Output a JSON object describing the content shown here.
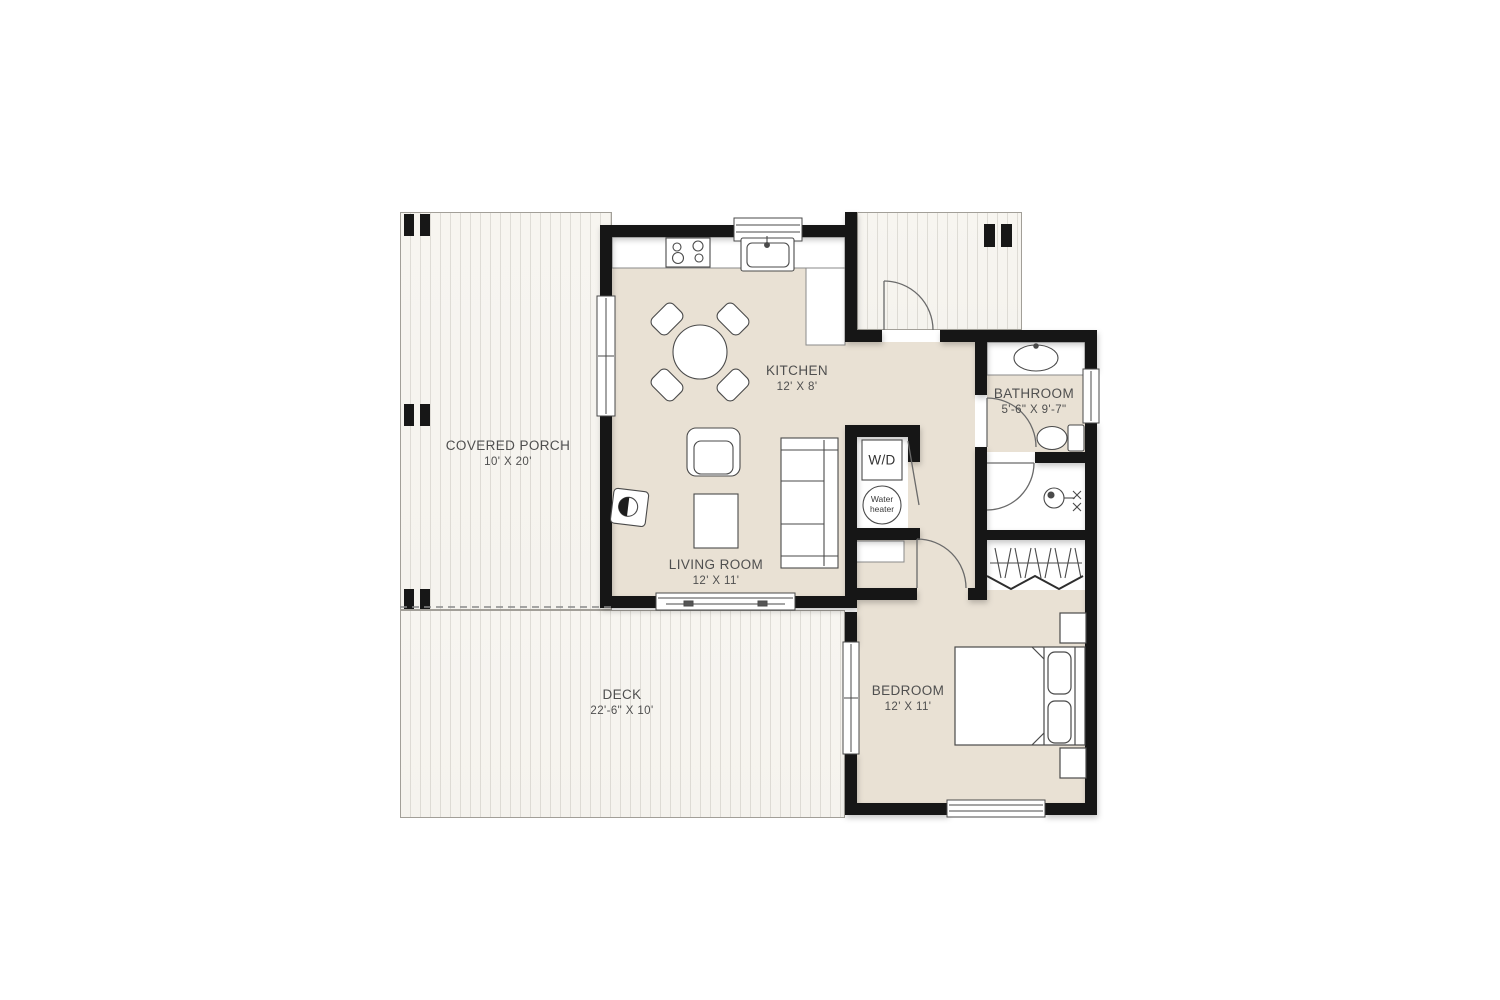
{
  "colors": {
    "wall": "#171717",
    "floor": "#e9e1d4",
    "porch_plank": "#f6f4ef",
    "fixture_outline": "#4a4a4a",
    "label_text": "#4f4f4f"
  },
  "rooms": {
    "covered_porch": {
      "name": "COVERED PORCH",
      "dims": "10' X 20'"
    },
    "kitchen": {
      "name": "KITCHEN",
      "dims": "12' X 8'"
    },
    "living_room": {
      "name": "LIVING ROOM",
      "dims": "12' X 11'"
    },
    "bathroom": {
      "name": "BATHROOM",
      "dims": "5'-6\" X 9'-7\""
    },
    "bedroom": {
      "name": "BEDROOM",
      "dims": "12' X 11'"
    },
    "deck": {
      "name": "DECK",
      "dims": "22'-6\" X 10'"
    }
  },
  "fixtures": {
    "washer_dryer": "W/D",
    "water_heater": "Water heater"
  }
}
